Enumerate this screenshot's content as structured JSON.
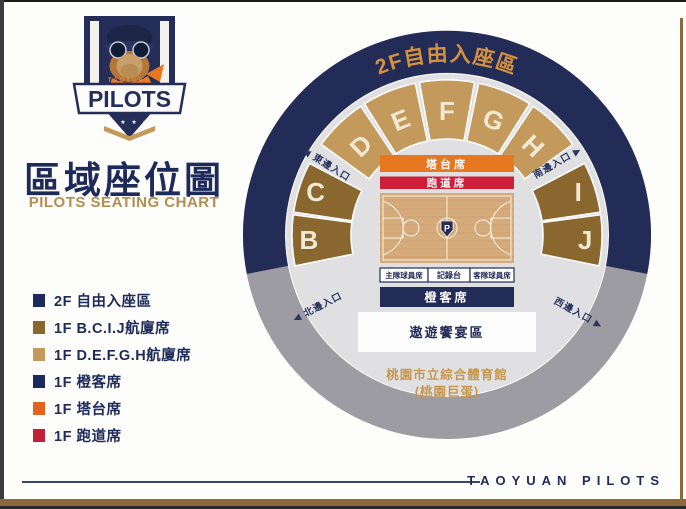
{
  "branding": {
    "city": "TAOYUAN",
    "wordmark": "PILOTS",
    "stars": "★ ★ ★ ★",
    "title": "區域座位圖",
    "subtitle": "PILOTS SEATING CHART",
    "footer_wordmark": "TAOYUAN  PILOTS"
  },
  "legend": {
    "items": [
      {
        "swatch": "#1c2a5e",
        "label": "2F 自由入座區"
      },
      {
        "swatch": "#8a672e",
        "label": "1F B.C.I.J航廈席"
      },
      {
        "swatch": "#c49a5c",
        "label": "1F D.E.F.G.H航廈席"
      },
      {
        "swatch": "#1c2a5e",
        "label": "1F 橙客席"
      },
      {
        "swatch": "#e2621f",
        "label": "1F 塔台席"
      },
      {
        "swatch": "#c21f38",
        "label": "1F 跑道席"
      }
    ]
  },
  "arena": {
    "upper_ring_label": "2F自由入座區",
    "section_labels": {
      "b": "B",
      "c": "C",
      "d": "D",
      "e": "E",
      "f": "F",
      "g": "G",
      "h": "H",
      "i": "I",
      "j": "J"
    },
    "entrances": {
      "east": "◀ 東邊入口",
      "south": "南邊入口 ▶",
      "north": "◀ 北邊入口",
      "west": "西邊入口 ▶"
    },
    "court": {
      "tower_seats": "塔台席",
      "runway_seats": "跑道席",
      "home_bench": "主隊球員席",
      "scorer_table": "記錄台",
      "away_bench": "客隊球員席",
      "away_seats": "橙客席",
      "banquet_zone": "遨遊饗宴區",
      "center_logo": "P"
    },
    "venue_name_line1": "桃園市立綜合體育館",
    "venue_name_line2": "(桃園巨蛋)"
  },
  "colors": {
    "navy": "#232c57",
    "ring_navy": "#222c56",
    "ring_gray": "#9c9ca2",
    "disc_gray": "#e0e0e3",
    "tan_sections": "#c49a5c",
    "brown_sections": "#8a672e",
    "orange_bar": "#e87722",
    "red_bar": "#ce1f3a",
    "arc_text_orange": "#d6913e",
    "venue_text_gold": "#c6984e",
    "title_navy": "#1e2b5a",
    "subtitle_gold": "#b28e50",
    "court_wood": "#d6ab7c"
  }
}
